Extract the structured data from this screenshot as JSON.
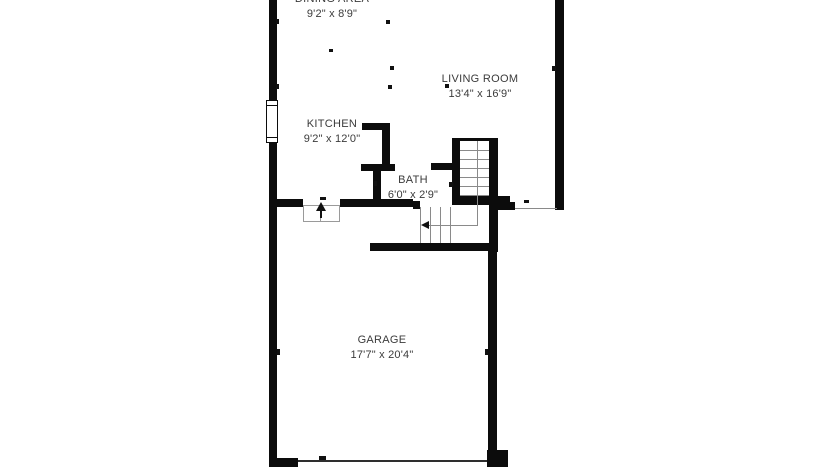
{
  "floorplan": {
    "background_color": "#ffffff",
    "wall_color": "#0c0c0c",
    "stair_line_color": "#8a8a8a",
    "text_color": "#3b3b3b",
    "rooms": [
      {
        "name": "DINING AREA",
        "dimensions": "9'2\" x 8'9\""
      },
      {
        "name": "LIVING ROOM",
        "dimensions": "13'4\" x 16'9\""
      },
      {
        "name": "KITCHEN",
        "dimensions": "9'2\" x 12'0\""
      },
      {
        "name": "BATH",
        "dimensions": "6'0\" x 2'9\""
      },
      {
        "name": "GARAGE",
        "dimensions": "17'7\" x 20'4\""
      }
    ]
  }
}
